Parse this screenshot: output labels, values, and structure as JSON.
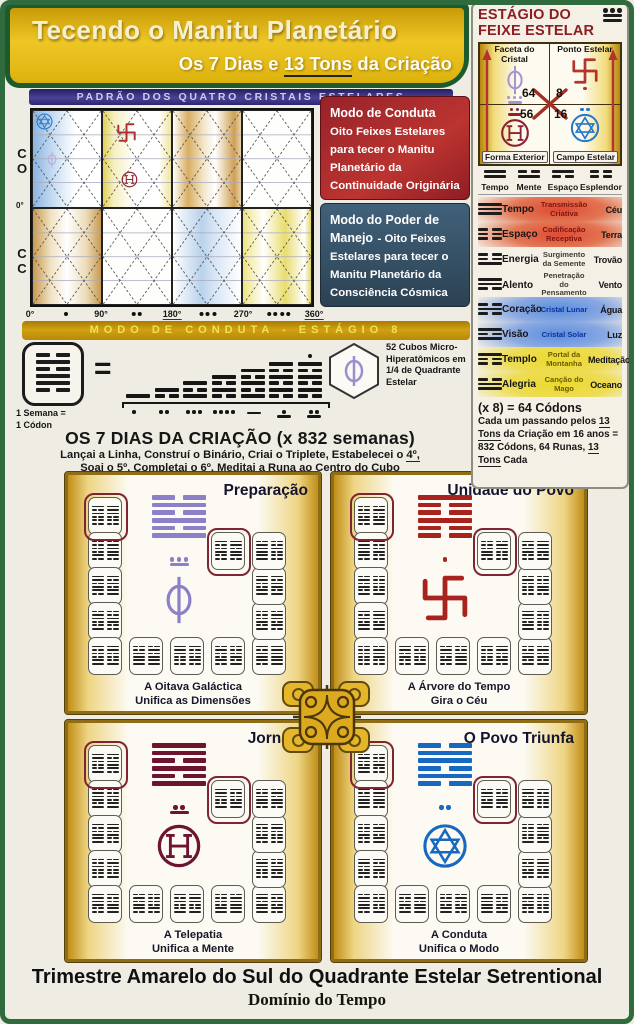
{
  "header": {
    "title": "Tecendo o Manitu Planetário",
    "subtitle": [
      {
        "t": "Os 7 Dias e "
      },
      {
        "t": "13 Tons",
        "u": true
      },
      {
        "t": " da Criação"
      }
    ]
  },
  "pattern_chart": {
    "banner": "PADRÃO DOS QUATRO CRISTAIS ESTELARES",
    "row_labels": [
      "CO",
      "CC"
    ],
    "zero_label": "0°",
    "x_ticks": [
      "0°",
      "90°",
      "180°",
      "270°",
      "360°"
    ],
    "tick_dots": [
      1,
      2,
      3,
      4
    ],
    "mode_red": {
      "title": "Modo de Conduta",
      "body": "Oito Feixes Estelares para tecer o Manitu Planetário da Continuidade Originária"
    },
    "mode_blue": {
      "title": "Modo do Poder de Manejo",
      "body": "- Oito Feixes Estelares para tecer o Manitu Planetário da Consciência Cósmica"
    },
    "bottom_banner": "MODO DE CONDUTA - ESTÁGIO 8"
  },
  "sidebar": {
    "title_line1": "ESTÁGIO DO",
    "title_line2": "FEIXE ESTELAR",
    "title_mayan": 13,
    "grid": [
      {
        "pos": "tl",
        "label": "Faceta do Cristal",
        "symbol": "phi",
        "color": "#a193d6",
        "number": "64",
        "mayan": 8
      },
      {
        "pos": "tr",
        "label": "Ponto Estelar",
        "symbol": "swastika",
        "color": "#b5342c",
        "number": "8",
        "mayan": 1
      },
      {
        "pos": "bl",
        "label": "Forma Exterior",
        "symbol": "earth",
        "color": "#8c2333",
        "number": "56",
        "mayan": 7
      },
      {
        "pos": "br",
        "label": "Campo Estelar",
        "symbol": "star",
        "color": "#2277cc",
        "number": "16",
        "mayan": 2
      }
    ],
    "bigrams": [
      {
        "label": "Tempo",
        "lines": [
          1,
          1
        ]
      },
      {
        "label": "Mente",
        "lines": [
          0,
          1
        ]
      },
      {
        "label": "Espaço",
        "lines": [
          1,
          0
        ]
      },
      {
        "label": "Esplendor",
        "lines": [
          0,
          0
        ]
      }
    ],
    "table": [
      {
        "trigram": [
          1,
          1,
          1
        ],
        "name": "Tempo",
        "desc": "Transmissão Criativa",
        "element": "Céu",
        "group": "red"
      },
      {
        "trigram": [
          0,
          0,
          0
        ],
        "name": "Espaço",
        "desc": "Codificação Receptiva",
        "element": "Terra",
        "group": "red"
      },
      {
        "trigram": [
          0,
          0,
          1
        ],
        "name": "Energia",
        "desc": "Surgimento da Semente",
        "element": "Trovão",
        "group": "plain"
      },
      {
        "trigram": [
          1,
          1,
          0
        ],
        "name": "Alento",
        "desc": "Penetração do Pensamento",
        "element": "Vento",
        "group": "plain"
      },
      {
        "trigram": [
          0,
          1,
          0
        ],
        "name": "Coração",
        "desc": "Cristal Lunar",
        "element": "Água",
        "group": "blue"
      },
      {
        "trigram": [
          1,
          0,
          1
        ],
        "name": "Visão",
        "desc": "Cristal Solar",
        "element": "Luz",
        "group": "blue"
      },
      {
        "trigram": [
          1,
          0,
          0
        ],
        "name": "Templo",
        "desc": "Portal da Montanha",
        "element": "Meditação",
        "group": "yellow"
      },
      {
        "trigram": [
          0,
          1,
          1
        ],
        "name": "Alegria",
        "desc": "Canção do Mago",
        "element": "Oceano",
        "group": "yellow"
      }
    ],
    "codons_line": "(x 8) = 64 Códons",
    "footnote": [
      {
        "t": "Cada um passando pelos "
      },
      {
        "t": "13 Tons",
        "u": true
      },
      {
        "t": " da Criação em 16 anos = 832 Códons, 64 Runas, "
      },
      {
        "t": "13 Tons",
        "u": true
      },
      {
        "t": " Cada"
      }
    ]
  },
  "seven_days": {
    "week_label1": "1 Semana =",
    "week_label2": "1 Códon",
    "equals": "=",
    "week_card_lines": [
      0,
      1,
      0,
      1,
      1,
      0
    ],
    "stack_heights": [
      1,
      2,
      3,
      4,
      5,
      6,
      6
    ],
    "day_numbers": [
      1,
      2,
      3,
      4,
      5,
      6,
      7
    ],
    "cube_note": "52 Cubos Micro-Hiperatômicos em 1/4 de Quadrante Estelar",
    "heading": "OS 7 DIAS DA CRIAÇÃO (x 832 semanas)",
    "instr1": [
      {
        "t": "Lançai a Linha, Construí o Binário, Criai o Triplete, Estabelecei o "
      },
      {
        "t": "4º,",
        "u": true
      }
    ],
    "instr2": [
      {
        "t": "Soai o "
      },
      {
        "t": "5º,",
        "u": true
      },
      {
        "t": " Completai o "
      },
      {
        "t": "6º,",
        "u": true
      },
      {
        "t": " Meditai a Runa ao Centro do Cubo"
      }
    ]
  },
  "quarters": {
    "cards_per_panel": 13,
    "panels": [
      {
        "title": "Preparação",
        "caption1": "A Oitava Galáctica",
        "caption2": "Unifica as Dimensões",
        "symbol": "phi",
        "color": "#8d7fc8",
        "mayan": 8,
        "hex": [
          0,
          1,
          0,
          1,
          0,
          1
        ]
      },
      {
        "title": "Unidade do Povo",
        "caption1": "A Árvore do Tempo",
        "caption2": "Gira o Céu",
        "symbol": "swastika",
        "color": "#a8231e",
        "mayan": 1,
        "hex": [
          1,
          0,
          0,
          1,
          0,
          0
        ]
      },
      {
        "title": "Jornada",
        "caption1": "A Telepatia",
        "caption2": "Unifica a Mente",
        "symbol": "earth",
        "color": "#6d1430",
        "mayan": 7,
        "hex": [
          1,
          1,
          0,
          1,
          0,
          1
        ]
      },
      {
        "title": "O Povo Triunfa",
        "caption1": "A Conduta",
        "caption2": "Unifica o Modo",
        "symbol": "star",
        "color": "#1668c0",
        "mayan": 2,
        "hex": [
          0,
          1,
          1,
          0,
          1,
          0
        ]
      }
    ]
  },
  "footer": {
    "line1": "Trimestre Amarelo do Sul do Quadrante Estelar Setrentional",
    "line2": "Domínio do Tempo"
  }
}
